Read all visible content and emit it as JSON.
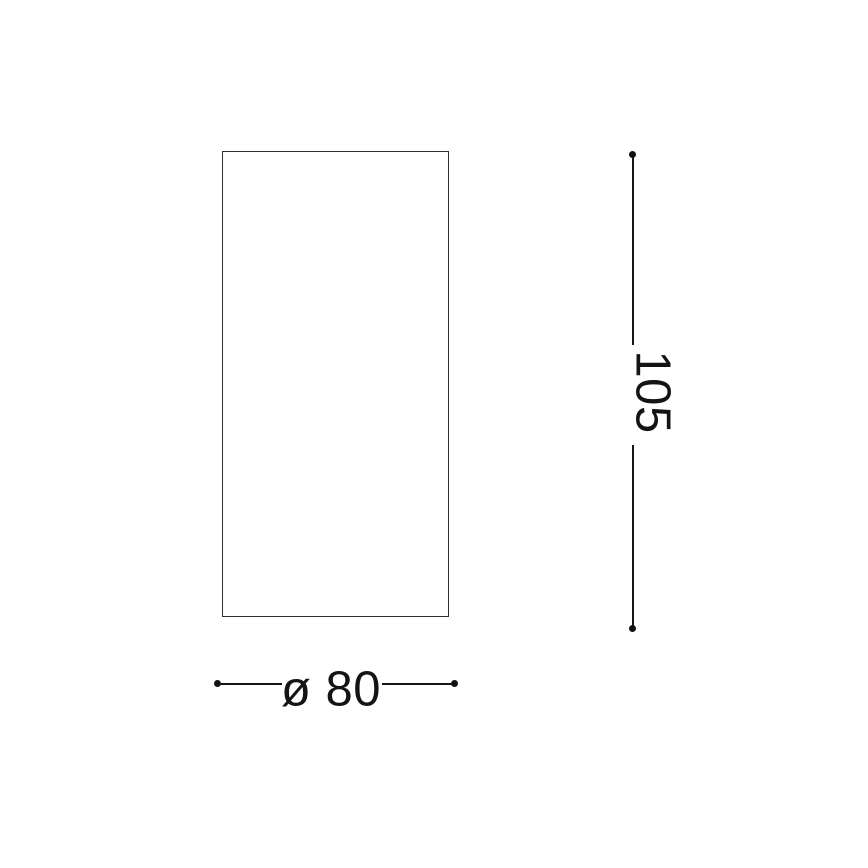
{
  "drawing": {
    "type": "technical-dimension-diagram",
    "shape": "rectangle",
    "background_color": "#ffffff",
    "line_color": "#161616",
    "outline_color": "#2e2e2e",
    "text_color": "#141414",
    "labels": {
      "height": "105",
      "diameter": "ø 80"
    },
    "dimensions": {
      "height": 105,
      "diameter": 80
    }
  }
}
